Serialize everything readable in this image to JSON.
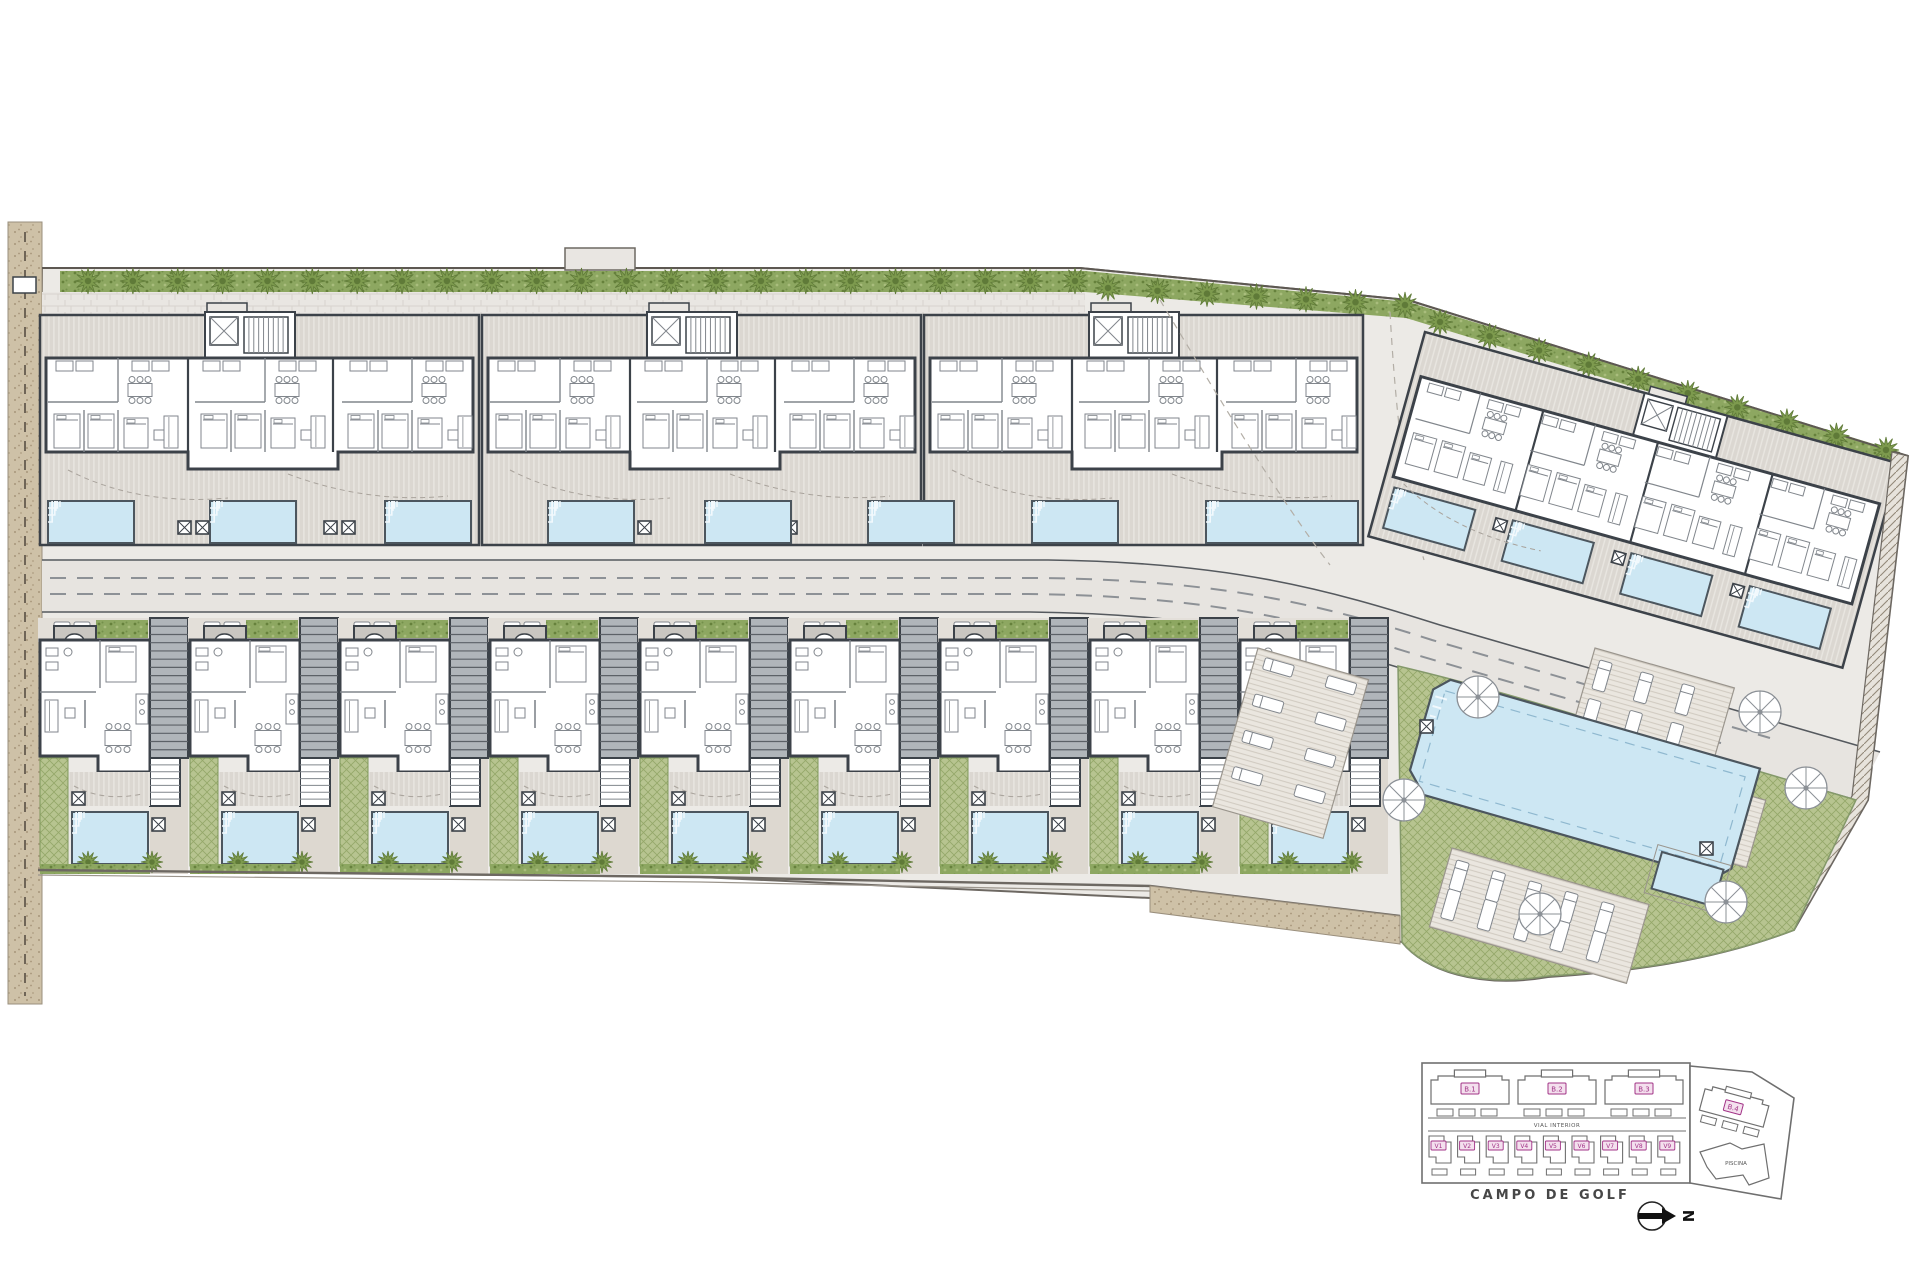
{
  "keyplan": {
    "block_labels": [
      "B.1",
      "B.2",
      "B.3"
    ],
    "block4_label": "B.4",
    "villa_labels": [
      "V1",
      "V2",
      "V3",
      "V4",
      "V5",
      "V6",
      "V7",
      "V8",
      "V9"
    ],
    "road_label": "VIAL INTERIOR",
    "pool_area_label": "PISCINA",
    "golf_course_label": "CAMPO DE GOLF",
    "compass_letter": "N"
  },
  "palette": {
    "walls": "#3c4249",
    "paving": "#eceae6",
    "terrace": "#dbd7d1",
    "pool_water": "#cde7f3",
    "pool_edge": "#4c565e",
    "lawn": "#b7c490",
    "hedge": "#8da761",
    "trees": "#7d9a4e",
    "sand_path": "#cec1a7",
    "road": "#e7e4e0",
    "furniture_line": "#81868c",
    "keyplan_label_text": "#a23387",
    "keyplan_label_fill": "#f4e0ee",
    "keyplan_line": "#6f6f6f"
  }
}
